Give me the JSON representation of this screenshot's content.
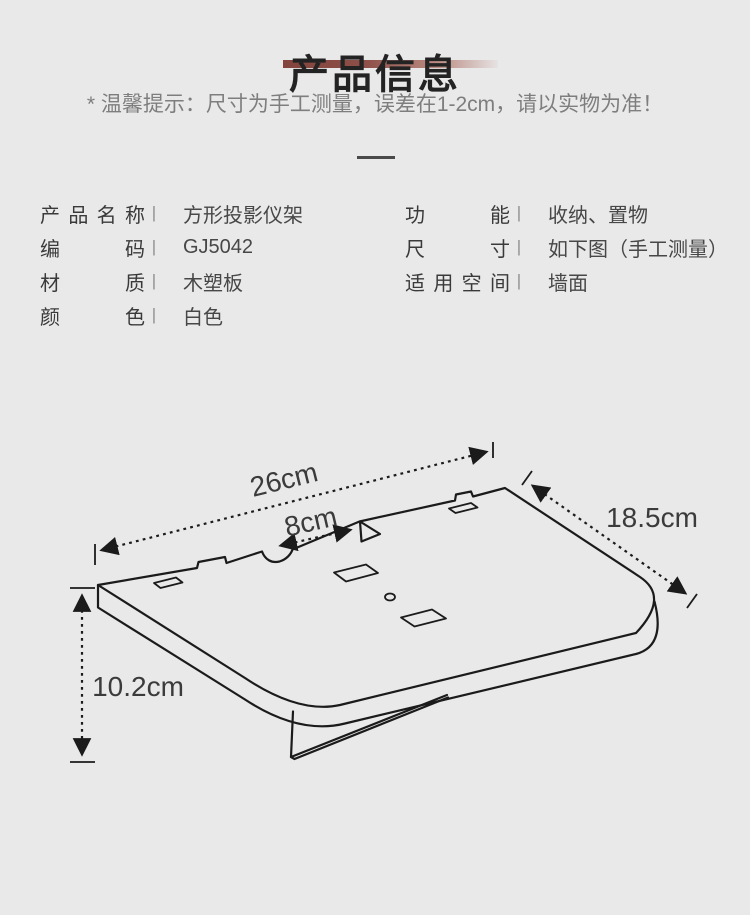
{
  "header": {
    "title": "产品信息",
    "tip": "* 温馨提示：尺寸为手工测量，误差在1-2cm，请以实物为准！"
  },
  "specs": {
    "separator": "|",
    "left": [
      {
        "label": "产品名称",
        "value": "方形投影仪架"
      },
      {
        "label": "编码",
        "value": "GJ5042"
      },
      {
        "label": "材质",
        "value": "木塑板"
      },
      {
        "label": "颜色",
        "value": "白色"
      }
    ],
    "right": [
      {
        "label": "功能",
        "value": "收纳、置物"
      },
      {
        "label": "尺寸",
        "value": "如下图（手工测量）"
      },
      {
        "label": "适用空间",
        "value": "墙面"
      }
    ]
  },
  "drawing": {
    "type": "isometric line drawing of wall-mounted projector shelf",
    "dimensions": {
      "width": "26cm",
      "slot": "8cm",
      "depth": "18.5cm",
      "height": "10.2cm"
    }
  },
  "colors": {
    "background": "#e9e9ea",
    "accent_bar": "#8d4f47",
    "line": "#1b1b1b",
    "tip_text": "#7e7e7e"
  }
}
